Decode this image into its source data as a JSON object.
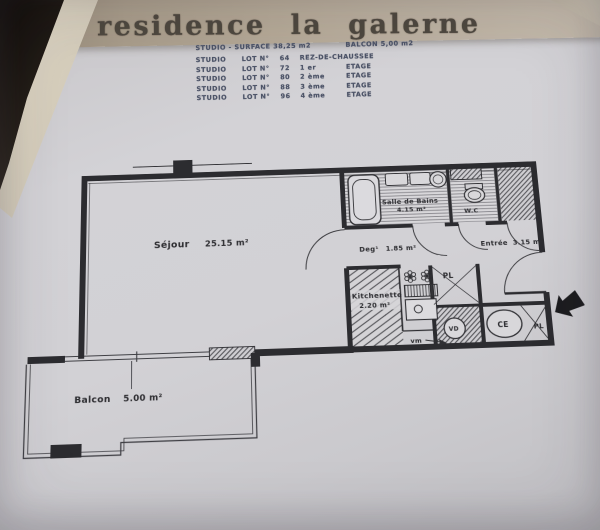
{
  "title": "residence la galerne",
  "header_table": {
    "surface_label": "STUDIO - SURFACE 38,25 m2",
    "balcon_label": "BALCON 5,00 m2",
    "rows": [
      {
        "type": "STUDIO",
        "lot": "LOT N°",
        "num": "64",
        "level": "REZ-DE-CHAUSSEE",
        "etage": ""
      },
      {
        "type": "STUDIO",
        "lot": "LOT N°",
        "num": "72",
        "level": "1 er",
        "etage": "ETAGE"
      },
      {
        "type": "STUDIO",
        "lot": "LOT N°",
        "num": "80",
        "level": "2 ème",
        "etage": "ETAGE"
      },
      {
        "type": "STUDIO",
        "lot": "LOT N°",
        "num": "88",
        "level": "3 ème",
        "etage": "ETAGE"
      },
      {
        "type": "STUDIO",
        "lot": "LOT N°",
        "num": "96",
        "level": "4 ème",
        "etage": "ETAGE"
      }
    ]
  },
  "plan": {
    "sejour": {
      "name": "Séjour",
      "area": "25.15 m²"
    },
    "salle_de_bains": {
      "name": "Salle de Bains",
      "area": "4.15 m²"
    },
    "wc": {
      "name": "W.C"
    },
    "degagement": {
      "name": "Deg¹",
      "area": "1.85 m²"
    },
    "entree": {
      "name": "Entrée",
      "area": "3.15 m²"
    },
    "kitchenette": {
      "name": "Kitchenette",
      "area": "2.20 m²"
    },
    "balcon": {
      "name": "Balcon",
      "area": "5.00 m²"
    },
    "closets": {
      "pl_top": "PL",
      "pl_right": "PL"
    },
    "equipment": {
      "vm": "vm",
      "vd": "VD",
      "ce": "CE"
    }
  },
  "colors": {
    "paper": "#d2d1d5",
    "band": "#b5a997",
    "ink": "#2d2d31",
    "table_ink": "#4d5468",
    "dark_corner": "#17120e",
    "page_edge": "#d7d0c0"
  }
}
